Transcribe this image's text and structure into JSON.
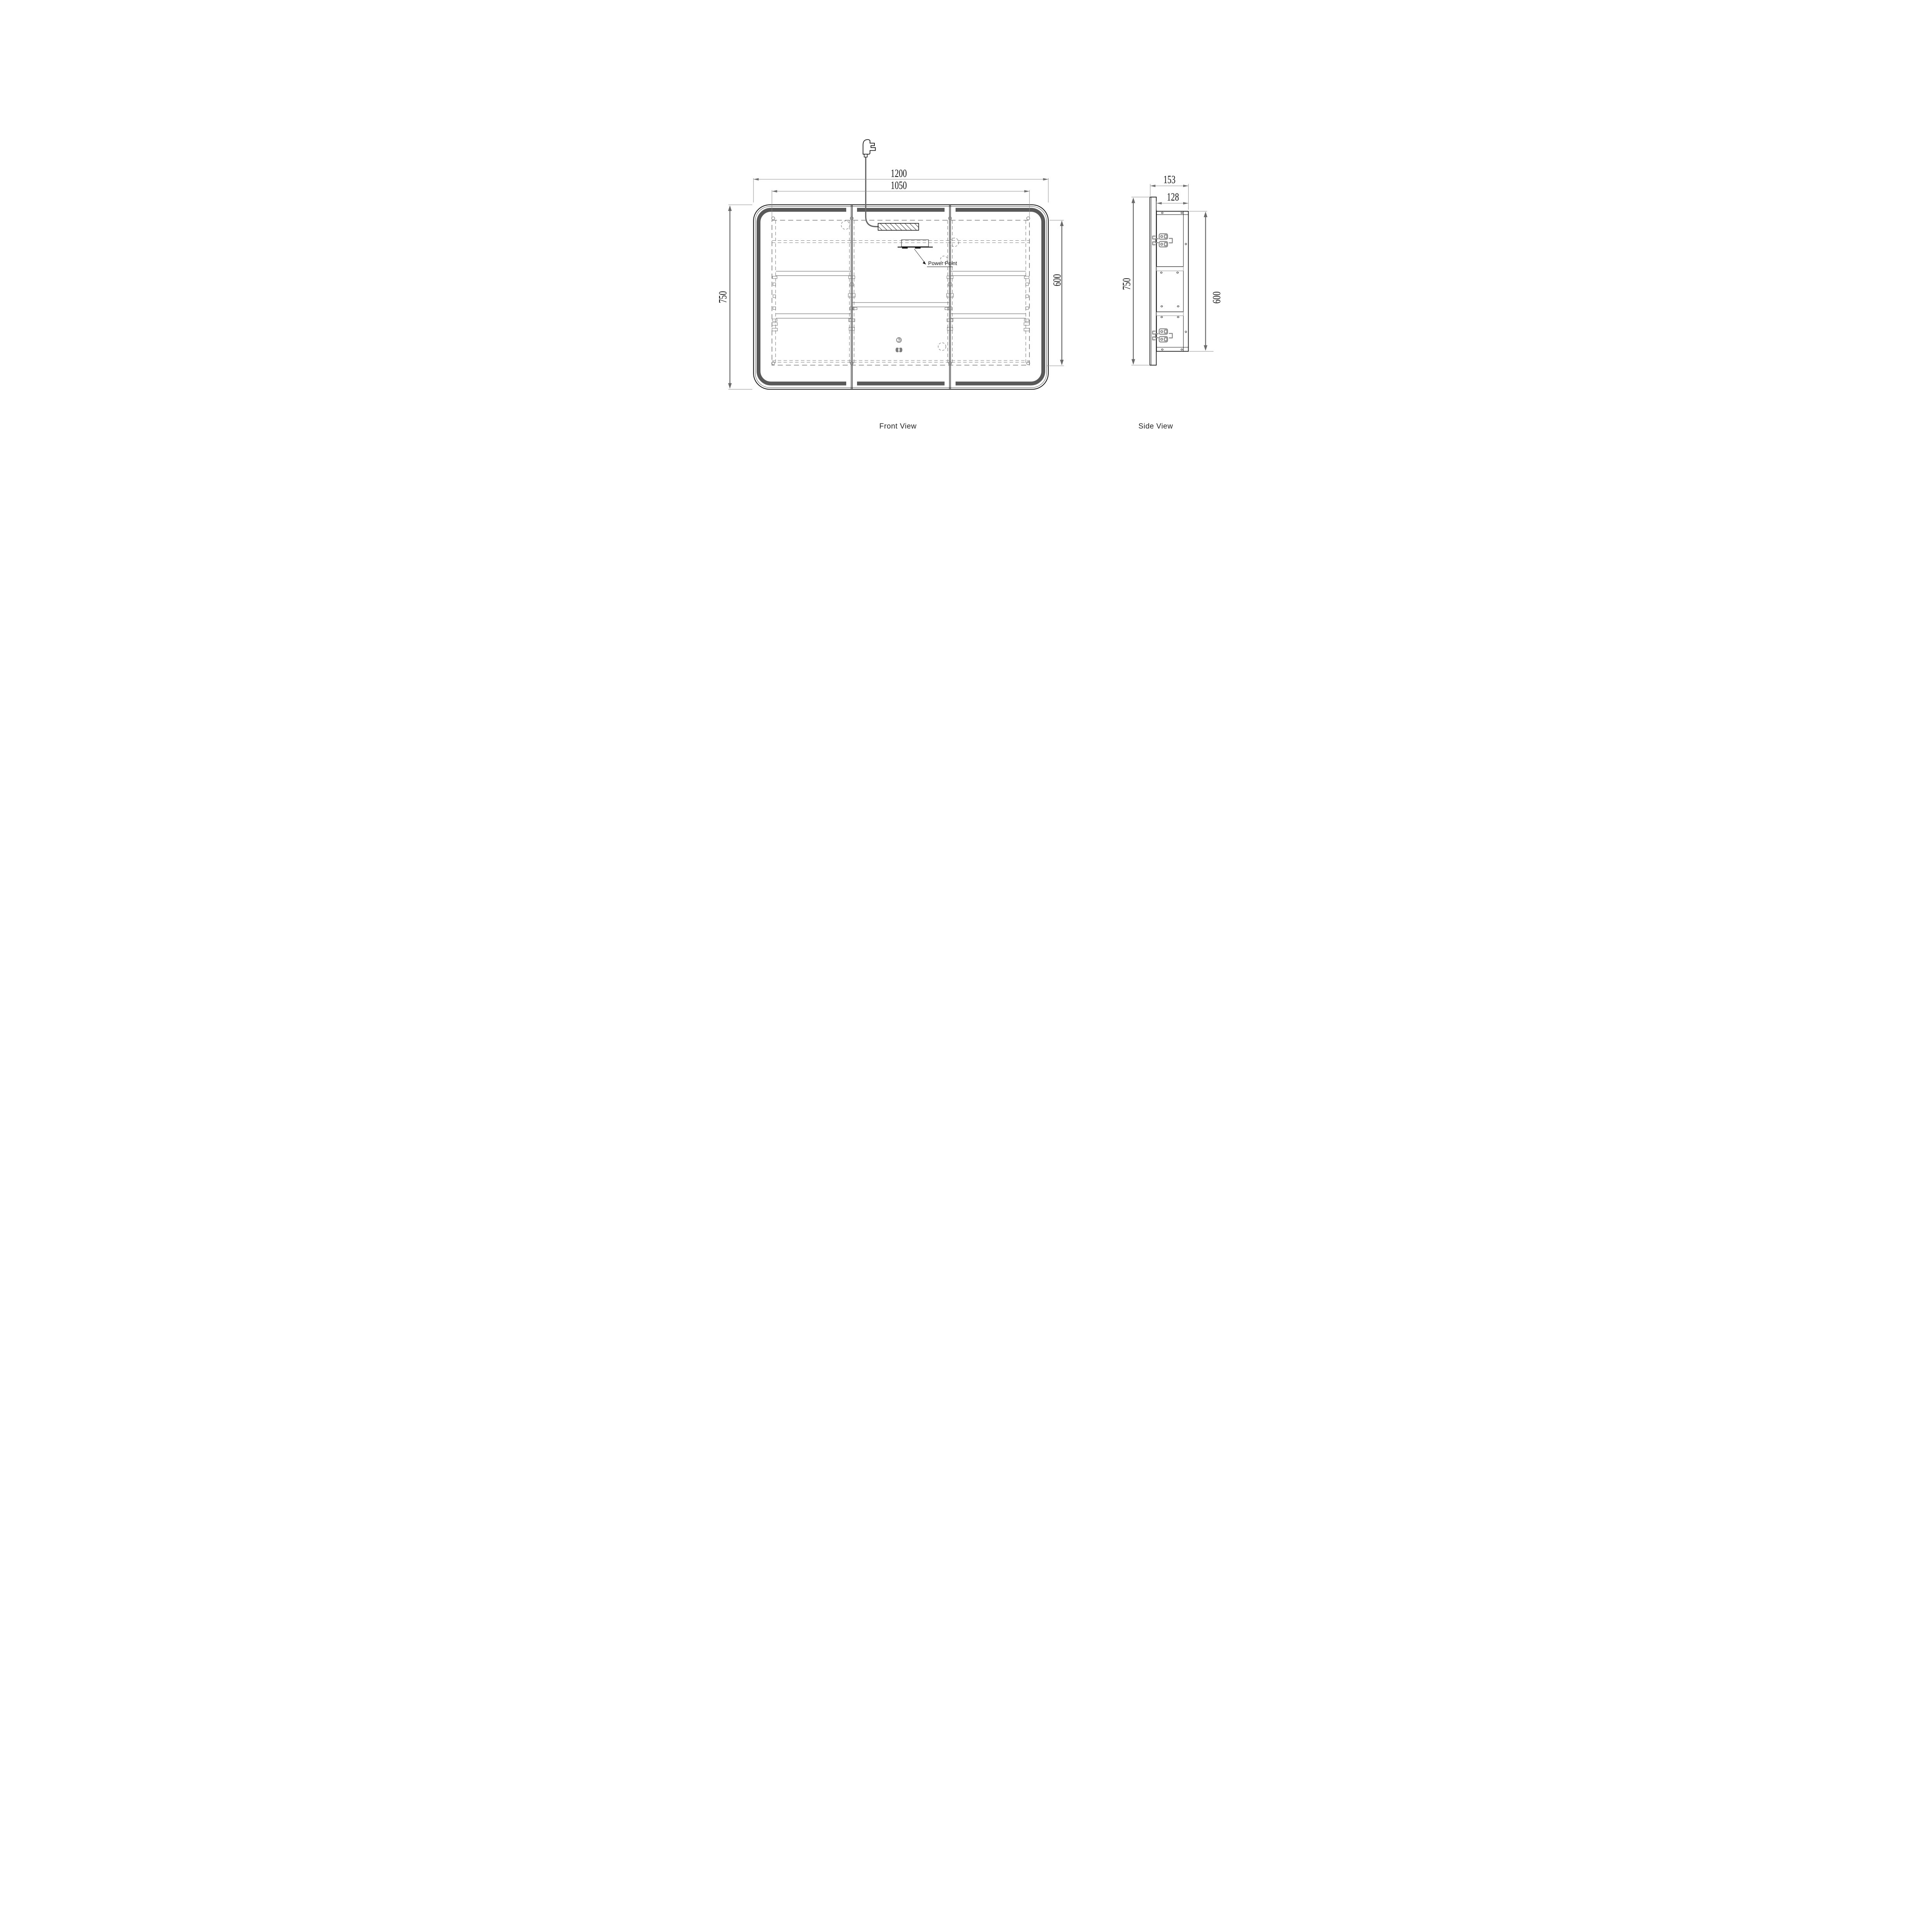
{
  "front": {
    "label": "Front View",
    "power_point_label": "Power Point",
    "dims": {
      "width": "1200",
      "body_width": "1050",
      "height": "750",
      "body_height": "600"
    }
  },
  "side": {
    "label": "Side View",
    "dims": {
      "depth": "153",
      "body_depth": "128",
      "height": "750",
      "body_height": "600"
    }
  },
  "colors": {
    "line": "#141414",
    "led_strip": "#595959",
    "dim_gray": "#6a6a6a",
    "hinge_gray": "#8a8a8a",
    "icon_gray": "#7d7d7d",
    "cord_gray": "#666666",
    "dashed_gray": "#7a7a7a"
  }
}
